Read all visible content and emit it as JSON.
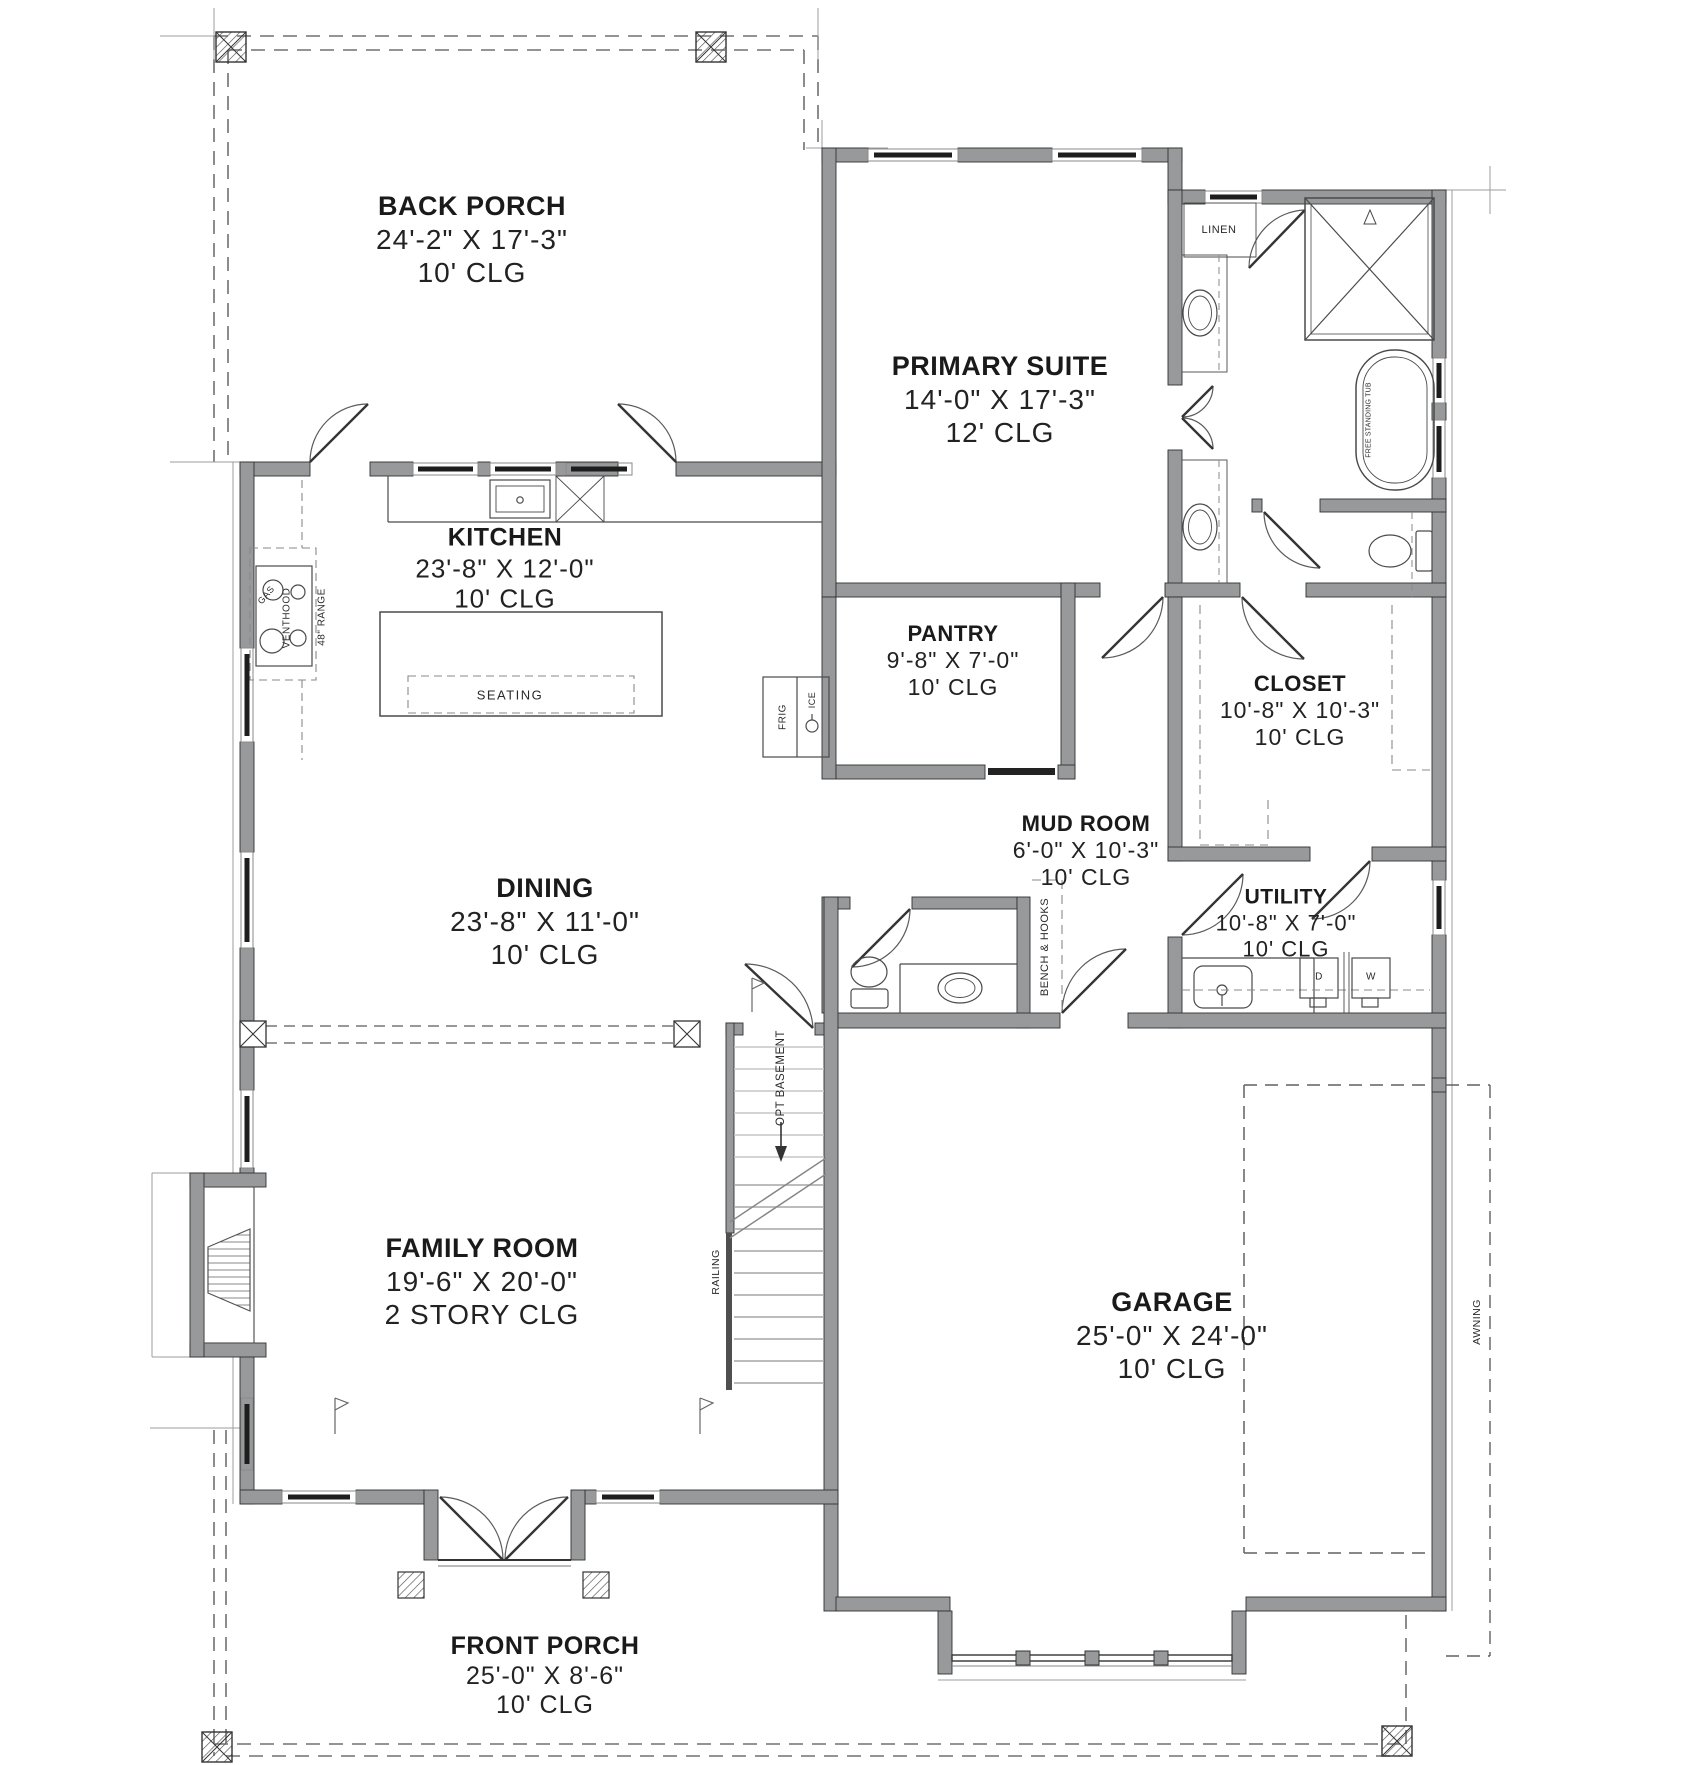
{
  "drawing": {
    "type": "architectural-floor-plan-first-floor",
    "background_color": "#ffffff",
    "wall_color": "#98999b",
    "line_color": "#3d3f40",
    "text_color": "#1a1a1a"
  },
  "rooms": [
    {
      "id": "back-porch",
      "name": "BACK PORCH",
      "dims": "24'-2\" X 17'-3\"",
      "ceiling": "10' CLG"
    },
    {
      "id": "primary-suite",
      "name": "PRIMARY SUITE",
      "dims": "14'-0\" X 17'-3\"",
      "ceiling": "12' CLG"
    },
    {
      "id": "kitchen",
      "name": "KITCHEN",
      "dims": "23'-8\" X 12'-0\"",
      "ceiling": "10' CLG"
    },
    {
      "id": "pantry",
      "name": "PANTRY",
      "dims": "9'-8\" X 7'-0\"",
      "ceiling": "10' CLG"
    },
    {
      "id": "closet",
      "name": "CLOSET",
      "dims": "10'-8\" X 10'-3\"",
      "ceiling": "10' CLG"
    },
    {
      "id": "mud-room",
      "name": "MUD ROOM",
      "dims": "6'-0\" X 10'-3\"",
      "ceiling": "10' CLG"
    },
    {
      "id": "utility",
      "name": "UTILITY",
      "dims": "10'-8\" X 7'-0\"",
      "ceiling": "10' CLG"
    },
    {
      "id": "dining",
      "name": "DINING",
      "dims": "23'-8\" X 11'-0\"",
      "ceiling": "10' CLG"
    },
    {
      "id": "family-room",
      "name": "FAMILY ROOM",
      "dims": "19'-6\" X 20'-0\"",
      "ceiling": "2 STORY CLG"
    },
    {
      "id": "garage",
      "name": "GARAGE",
      "dims": "25'-0\" X 24'-0\"",
      "ceiling": "10' CLG"
    },
    {
      "id": "front-porch",
      "name": "FRONT PORCH",
      "dims": "25'-0\" X 8'-6\"",
      "ceiling": "10' CLG"
    }
  ],
  "fixtures": {
    "linen": "LINEN",
    "tub": "FREE STANDING TUB",
    "venthood": "VENTHOOD",
    "gas": "GAS",
    "range": "48\" RANGE",
    "seating": "SEATING",
    "frig": "FRIG",
    "ice": "ICE",
    "bench": "BENCH & HOOKS",
    "opt_basement": "OPT BASEMENT",
    "railing": "RAILING",
    "awning": "AWNING",
    "dryer": "D",
    "washer": "W"
  }
}
